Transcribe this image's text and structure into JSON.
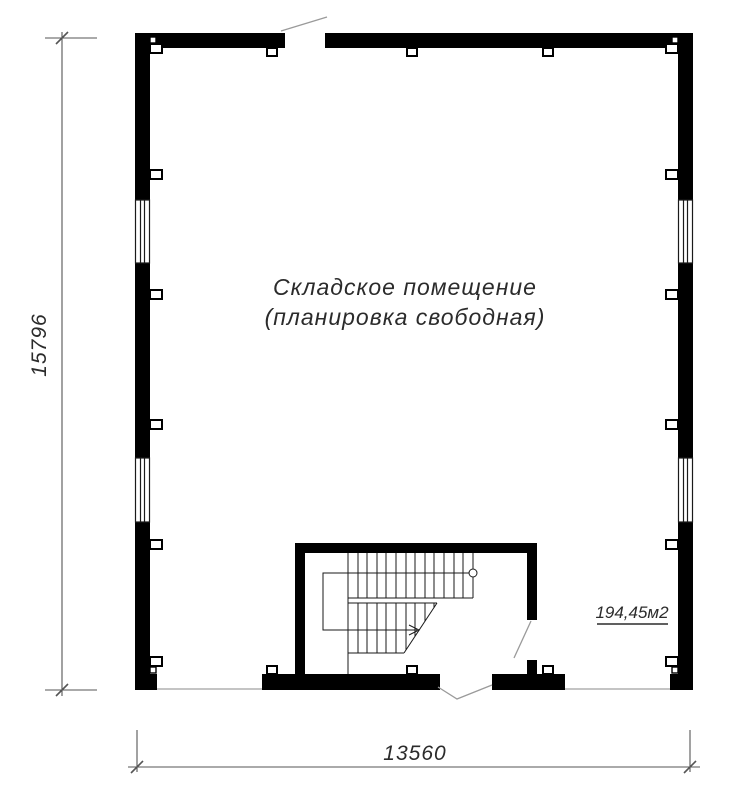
{
  "drawing": {
    "title": "floor-plan",
    "room_label": {
      "line1": "Складское помещение",
      "line2": "(планировка свободная)"
    },
    "area_label": "194,45м2",
    "dimensions": {
      "left_vertical": "15796",
      "bottom_horizontal": "13560"
    },
    "colors": {
      "wall": "#000000",
      "thin_line": "#1a1a1a",
      "door_leaf": "#9a9a9a",
      "dimension_line": "#555555",
      "text": "#2b2b2b"
    }
  }
}
